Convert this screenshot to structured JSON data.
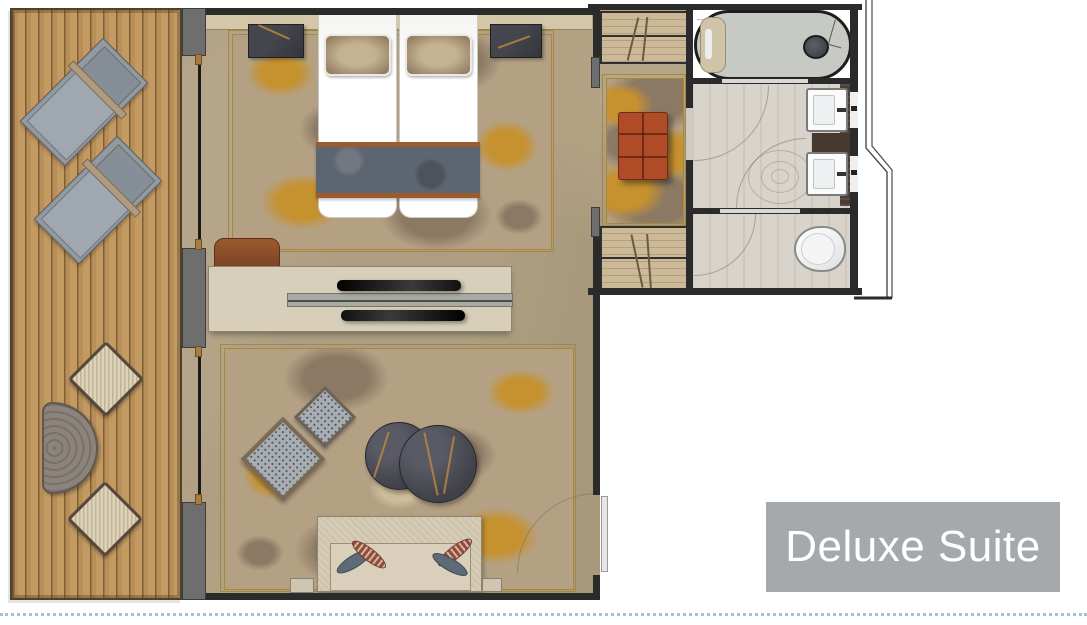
{
  "label": {
    "text": "Deluxe Suite"
  },
  "palette": {
    "label_bg": "#a6a9ab",
    "label_text": "#ffffff",
    "deck_wood": "#c49a63",
    "interior_floor": "#b2a183",
    "carpet_base": "#b4a184",
    "carpet_gold": "#c6912f",
    "carpet_brown": "#8b7964",
    "wall_dark": "#2b2b2b",
    "wall_gray": "#6e6e6e",
    "bed_runner_slate": "#5d6570",
    "bed_runner_copper": "#9c5a30",
    "ottoman_terracotta": "#b04b28",
    "lounger_gray": "#9199a1",
    "wicker_cream": "#ddd3b8",
    "shower_gray": "#c7c9c5",
    "bath_tile": "#d8d4cc",
    "fixture_white": "#fbfbfb",
    "footer_dotted_line": "#9fc3da"
  },
  "furniture_legend": {
    "balcony": [
      "sun-lounger",
      "sun-lounger",
      "wicker-chair",
      "wicker-chair",
      "side-table"
    ],
    "bedroom": [
      "twin-bed",
      "twin-bed",
      "nightstand",
      "nightstand",
      "headboard-shelf",
      "bedroom-carpet"
    ],
    "divider": [
      "tv-console",
      "tv-screen",
      "bench"
    ],
    "living_room": [
      "armchair",
      "armchair",
      "coffee-table",
      "coffee-table",
      "sofa",
      "living-carpet",
      "entry-door"
    ],
    "dressing_area": [
      "wardrobe",
      "wardrobe",
      "ottoman",
      "runner-rug"
    ],
    "bathroom": [
      "shower",
      "shower-bench",
      "washbasin",
      "washbasin",
      "vanity-counter",
      "toilet"
    ]
  }
}
